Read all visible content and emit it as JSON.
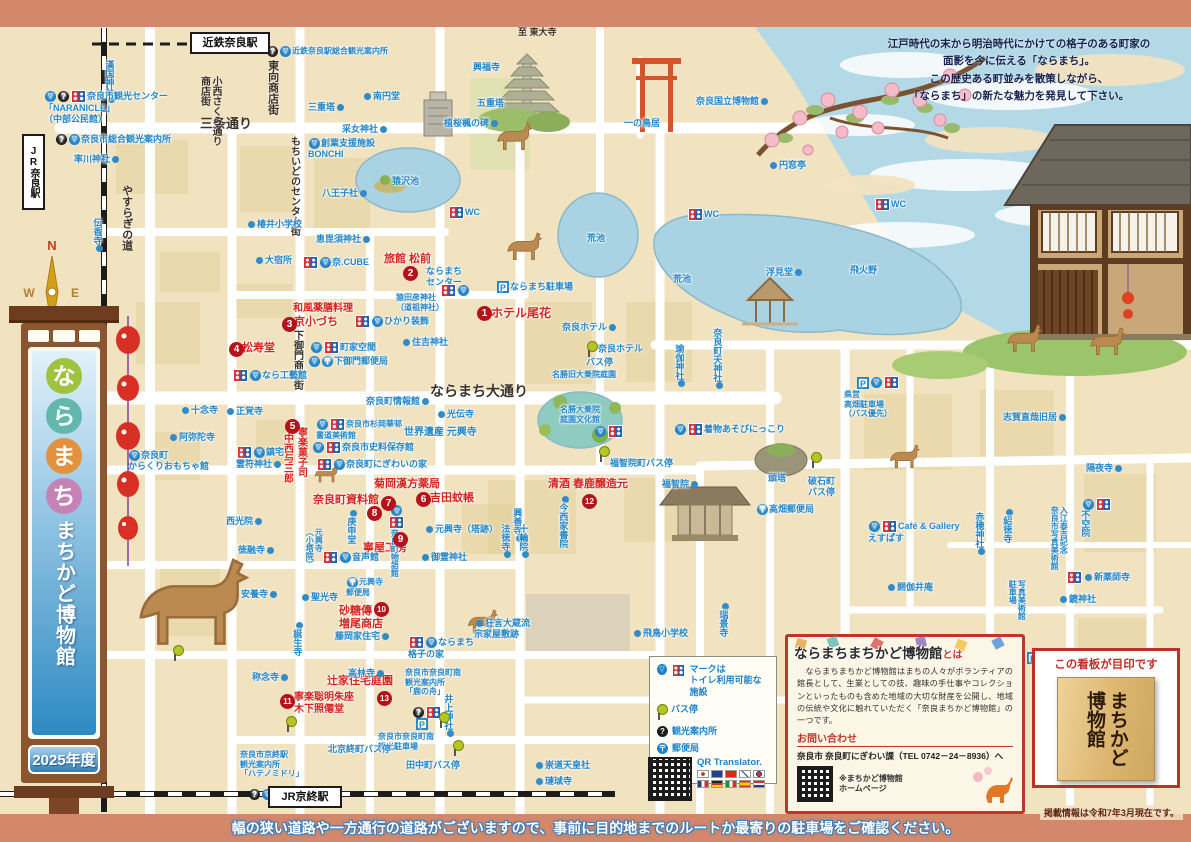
{
  "title": "ならまち まちかど博物館 マップ 2025年度",
  "header": {
    "note": "江戸時代の末から明治時代にかけての格子のある町家の\n面影を今に伝える「ならまち」。\nこの歴史ある町並みを散策しながら、\n「ならまち」の新たな魅力を発見して下さい。"
  },
  "stations": {
    "kintetsu": "近鉄奈良駅",
    "jr_nara": "JR奈良駅",
    "jr_kyobate": "JR京終駅"
  },
  "compass": {
    "n": "N",
    "e": "E",
    "w": "W",
    "s": "S"
  },
  "sidebar_sign": {
    "chars": [
      {
        "ch": "な",
        "color": "#9fc23f"
      },
      {
        "ch": "ら",
        "color": "#62b8ad"
      },
      {
        "ch": "ま",
        "color": "#e2923f"
      },
      {
        "ch": "ち",
        "color": "#c583b5"
      }
    ],
    "subtitle": "まちかど博物館",
    "year": "2025年度"
  },
  "legend": {
    "row1": "マークは\nトイレ利用可能な施設",
    "row2": "バス停",
    "row3": "観光案内所",
    "row4": "郵便局"
  },
  "qr_translator": {
    "label": "QR Translator."
  },
  "info_box": {
    "title": "ならまちまちかど博物館",
    "title_suffix": "とは",
    "body": "　ならまちまちかど博物館はまちの人々がボランティアの館長として、生業としての技、趣味の手仕事やコレクションといったものも含めた地域の大切な財産を公開し、地域の伝統や文化に触れていただく「奈良まちかど博物館」の一つです。",
    "contact_heading": "お問い合わせ",
    "contact": "奈良市 奈良町にぎわい課（TEL 0742－24－8936）へ",
    "qr_caption": "※まちかど博物館\nホームページ"
  },
  "signboard_box": {
    "caption": "この看板が目印です",
    "board_text": "まちかど\n博物館"
  },
  "footer": {
    "warning": "幅の狭い道路や一方通行の道路がございますので、事前に目的地までのルートか最寄りの駐車場をご確認ください。",
    "note": "掲載情報は令和7年3月現在です。"
  },
  "museums": [
    {
      "no": 1,
      "name": "ホテル尾花"
    },
    {
      "no": 2,
      "name": "旅館 松前"
    },
    {
      "no": 3,
      "name": "和風薬膳料理 京小づち"
    },
    {
      "no": 4,
      "name": "松寿堂"
    },
    {
      "no": 5,
      "name": "寧楽菓子司 中西与三郎"
    },
    {
      "no": 6,
      "name": "吉田蚊帳"
    },
    {
      "no": 7,
      "name": "菊岡漢方薬局"
    },
    {
      "no": 8,
      "name": "奈良町資料館"
    },
    {
      "no": 9,
      "name": "寧屋工房"
    },
    {
      "no": 10,
      "name": "砂糖傳 増尾商店"
    },
    {
      "no": 11,
      "name": "寧楽聡明朱座 木下照僊堂"
    },
    {
      "no": 12,
      "name": "清酒 春鹿醸造元"
    },
    {
      "no": 13,
      "name": "辻家住宅庭園"
    }
  ],
  "badges": [
    {
      "n": "1",
      "x": 477,
      "y": 306
    },
    {
      "n": "2",
      "x": 403,
      "y": 266
    },
    {
      "n": "3",
      "x": 282,
      "y": 317
    },
    {
      "n": "4",
      "x": 229,
      "y": 342
    },
    {
      "n": "5",
      "x": 285,
      "y": 419
    },
    {
      "n": "6",
      "x": 416,
      "y": 492
    },
    {
      "n": "7",
      "x": 381,
      "y": 496
    },
    {
      "n": "8",
      "x": 367,
      "y": 506
    },
    {
      "n": "9",
      "x": 393,
      "y": 532
    },
    {
      "n": "10",
      "x": 374,
      "y": 602
    },
    {
      "n": "11",
      "x": 280,
      "y": 694
    },
    {
      "n": "12",
      "x": 582,
      "y": 494
    },
    {
      "n": "13",
      "x": 377,
      "y": 691
    }
  ],
  "map_labels": [
    {
      "t": "三条通り",
      "x": 200,
      "y": 116,
      "c": "k",
      "s": 13
    },
    {
      "t": "やすらぎの道",
      "x": 120,
      "y": 185,
      "c": "k",
      "v": 1,
      "s": 11
    },
    {
      "t": "小西さくら通り\n商店街",
      "x": 198,
      "y": 76,
      "c": "k",
      "v": 1,
      "s": 10
    },
    {
      "t": "東向商店街",
      "x": 266,
      "y": 60,
      "c": "k",
      "v": 1,
      "s": 11
    },
    {
      "t": "もちいどのセンター街",
      "x": 288,
      "y": 136,
      "c": "k",
      "v": 1,
      "s": 10
    },
    {
      "t": "下御門商店街",
      "x": 291,
      "y": 330,
      "c": "k",
      "v": 1,
      "s": 10
    },
    {
      "t": "ならまち大通り",
      "x": 430,
      "y": 383,
      "c": "k",
      "s": 14
    },
    {
      "t": "至 東大寺",
      "x": 518,
      "y": 27,
      "c": "k",
      "s": 9
    },
    {
      "t": "ホテル尾花",
      "x": 491,
      "y": 306,
      "c": "r",
      "s": 12
    },
    {
      "t": "旅館 松前",
      "x": 384,
      "y": 253,
      "c": "r",
      "s": 11
    },
    {
      "t": "和風薬膳料理",
      "x": 293,
      "y": 303,
      "c": "r",
      "s": 10
    },
    {
      "t": "京小づち",
      "x": 294,
      "y": 316,
      "c": "r",
      "s": 11
    },
    {
      "t": "松寿堂",
      "x": 242,
      "y": 342,
      "c": "r",
      "s": 11
    },
    {
      "t": "寧楽菓子司",
      "x": 295,
      "y": 427,
      "c": "r",
      "v": 1,
      "s": 10
    },
    {
      "t": "中西与三郎",
      "x": 281,
      "y": 433,
      "c": "r",
      "v": 1,
      "s": 10
    },
    {
      "t": "吉田蚊帳",
      "x": 430,
      "y": 492,
      "c": "r",
      "s": 11
    },
    {
      "t": "菊岡漢方薬局",
      "x": 374,
      "y": 478,
      "c": "r",
      "s": 11
    },
    {
      "t": "奈良町資料館",
      "x": 313,
      "y": 494,
      "c": "r",
      "s": 11
    },
    {
      "t": "寧屋工房",
      "x": 363,
      "y": 542,
      "c": "r",
      "s": 11
    },
    {
      "t": "砂糖傳\n増尾商店",
      "x": 339,
      "y": 605,
      "c": "r",
      "s": 11
    },
    {
      "t": "寧楽聡明朱座\n木下照僊堂",
      "x": 294,
      "y": 692,
      "c": "r",
      "s": 10
    },
    {
      "t": "清酒 春鹿醸造元",
      "x": 548,
      "y": 478,
      "c": "r",
      "s": 11
    },
    {
      "t": "辻家住宅庭園",
      "x": 327,
      "y": 675,
      "c": "r",
      "s": 11
    },
    {
      "t": "漢国神社",
      "x": 104,
      "y": 60,
      "v": 1,
      "d": "b"
    },
    {
      "t": "奈良市観光センター\n「NARANICLE」\n（中部公民館）",
      "x": 44,
      "y": 90,
      "i": [
        "tri",
        "info",
        "wc"
      ]
    },
    {
      "t": "奈良市総合観光案内所",
      "x": 55,
      "y": 134,
      "i": [
        "info",
        "tri"
      ]
    },
    {
      "t": "率川神社",
      "x": 74,
      "y": 154,
      "d": "r"
    },
    {
      "t": "伝香寺",
      "x": 92,
      "y": 218,
      "v": 1,
      "d": "r"
    },
    {
      "t": "近鉄奈良駅総合観光案内所",
      "x": 266,
      "y": 46,
      "s": 8,
      "i": [
        "info",
        "tri"
      ]
    },
    {
      "t": "南円堂",
      "x": 362,
      "y": 91,
      "d": "l"
    },
    {
      "t": "三重塔",
      "x": 308,
      "y": 102,
      "d": "r"
    },
    {
      "t": "采女神社",
      "x": 342,
      "y": 124,
      "d": "r"
    },
    {
      "t": "創業支援施設\nBONCHI",
      "x": 308,
      "y": 138,
      "i": [
        "tri"
      ]
    },
    {
      "t": "八王子社",
      "x": 322,
      "y": 188,
      "d": "r"
    },
    {
      "t": "椿井小学校",
      "x": 246,
      "y": 219,
      "d": "l"
    },
    {
      "t": "恵毘須神社",
      "x": 316,
      "y": 234,
      "d": "r"
    },
    {
      "t": "大宿所",
      "x": 254,
      "y": 255,
      "d": "l"
    },
    {
      "t": "奈.CUBE",
      "x": 302,
      "y": 256,
      "i": [
        "wc",
        "tri"
      ]
    },
    {
      "t": "ならまち\nセンター",
      "x": 426,
      "y": 266
    },
    {
      "i": [
        "wc",
        "tri"
      ],
      "x": 440,
      "y": 284
    },
    {
      "t": "猿田彦神社\n（道祖神社）",
      "x": 396,
      "y": 293,
      "s": 8
    },
    {
      "t": "ならまち駐車場",
      "x": 496,
      "y": 281,
      "i": [
        "p"
      ]
    },
    {
      "t": "住吉神社",
      "x": 401,
      "y": 337,
      "d": "l"
    },
    {
      "t": "ひかり装飾",
      "x": 354,
      "y": 315,
      "i": [
        "wc",
        "tri"
      ]
    },
    {
      "t": "町家空間",
      "x": 310,
      "y": 341,
      "i": [
        "tri",
        "wc"
      ]
    },
    {
      "t": "下御門郵便局",
      "x": 308,
      "y": 356,
      "i": [
        "tri",
        "post"
      ]
    },
    {
      "t": "なら工藝館",
      "x": 232,
      "y": 369,
      "i": [
        "wc",
        "tri"
      ]
    },
    {
      "t": "興福寺",
      "x": 473,
      "y": 62
    },
    {
      "t": "五重塔",
      "x": 477,
      "y": 98
    },
    {
      "t": "植桜楓の碑",
      "x": 444,
      "y": 118,
      "d": "r"
    },
    {
      "t": "猿沢池",
      "x": 392,
      "y": 176
    },
    {
      "t": "WC",
      "x": 448,
      "y": 206,
      "i": [
        "wc"
      ]
    },
    {
      "t": "WC",
      "x": 687,
      "y": 208,
      "i": [
        "wc"
      ]
    },
    {
      "t": "WC",
      "x": 874,
      "y": 198,
      "i": [
        "wc"
      ]
    },
    {
      "t": "一の鳥居",
      "x": 624,
      "y": 118
    },
    {
      "t": "奈良国立博物館",
      "x": 696,
      "y": 96,
      "d": "b"
    },
    {
      "t": "円窓亭",
      "x": 768,
      "y": 160,
      "d": "a"
    },
    {
      "t": "浮見堂",
      "x": 766,
      "y": 267,
      "d": "b"
    },
    {
      "t": "飛火野",
      "x": 850,
      "y": 265
    },
    {
      "t": "荒池",
      "x": 587,
      "y": 233
    },
    {
      "t": "荒池",
      "x": 673,
      "y": 274
    },
    {
      "t": "奈良ホテル",
      "x": 562,
      "y": 322,
      "d": "b"
    },
    {
      "t": "奈良ホテル\nバス停",
      "x": 586,
      "y": 341,
      "i": [
        "pin"
      ]
    },
    {
      "t": "瑜伽神社",
      "x": 674,
      "y": 344,
      "v": 1,
      "d": "b"
    },
    {
      "t": "奈良町天神社",
      "x": 712,
      "y": 328,
      "v": 1,
      "d": "b"
    },
    {
      "t": "名勝旧大乗院庭園",
      "x": 552,
      "y": 370,
      "s": 8
    },
    {
      "t": "名勝大乗院\n庭園文化館",
      "x": 560,
      "y": 405,
      "s": 8
    },
    {
      "i": [
        "tri",
        "wc"
      ],
      "x": 594,
      "y": 425
    },
    {
      "t": "県営\n高畑駐車場\n（バス優先）",
      "x": 844,
      "y": 390,
      "s": 8
    },
    {
      "i": [
        "p",
        "tri",
        "wc"
      ],
      "x": 856,
      "y": 376
    },
    {
      "t": "着物あそびにっこり",
      "x": 674,
      "y": 423,
      "i": [
        "tri",
        "wc"
      ]
    },
    {
      "t": "福智院町バス停",
      "x": 610,
      "y": 458
    },
    {
      "i": [
        "pin"
      ],
      "x": 598,
      "y": 446
    },
    {
      "t": "福智院",
      "x": 662,
      "y": 479,
      "d": "b"
    },
    {
      "t": "頭塔",
      "x": 768,
      "y": 473
    },
    {
      "t": "破石町\nバス停",
      "x": 808,
      "y": 476
    },
    {
      "i": [
        "pin"
      ],
      "x": 810,
      "y": 452
    },
    {
      "t": "高畑郵便局",
      "x": 756,
      "y": 504,
      "i": [
        "post"
      ]
    },
    {
      "t": "閼伽井庵",
      "x": 886,
      "y": 582,
      "d": "l"
    },
    {
      "t": "Café & Gallery\nえすぱす",
      "x": 868,
      "y": 520,
      "i": [
        "tri",
        "wc"
      ]
    },
    {
      "t": "赤穂神社",
      "x": 974,
      "y": 512,
      "v": 1,
      "d": "b"
    },
    {
      "t": "紹徳寺",
      "x": 1002,
      "y": 509,
      "v": 1,
      "d": "a"
    },
    {
      "t": "志賀直哉旧居",
      "x": 1003,
      "y": 412,
      "d": "b"
    },
    {
      "t": "隔夜寺",
      "x": 1086,
      "y": 463,
      "d": "r"
    },
    {
      "t": "不空院",
      "x": 1080,
      "y": 510,
      "v": 1
    },
    {
      "i": [
        "tri",
        "wc"
      ],
      "x": 1082,
      "y": 498
    },
    {
      "t": "入江泰吉記念\n奈良市写真美術館",
      "x": 1050,
      "y": 506,
      "v": 1,
      "s": 8
    },
    {
      "t": "新薬師寺",
      "x": 1066,
      "y": 571,
      "d": "l",
      "i": [
        "wc"
      ]
    },
    {
      "t": "鏡神社",
      "x": 1058,
      "y": 594,
      "d": "l"
    },
    {
      "t": "写真美術館\n駐車場",
      "x": 1008,
      "y": 580,
      "v": 1,
      "s": 8
    },
    {
      "i": [
        "p"
      ],
      "x": 1026,
      "y": 652
    },
    {
      "t": "奈良町情報館",
      "x": 366,
      "y": 396,
      "d": "b"
    },
    {
      "t": "光伝寺",
      "x": 436,
      "y": 409,
      "d": "l"
    },
    {
      "t": "世界遺産 元興寺",
      "x": 404,
      "y": 427,
      "s": 10
    },
    {
      "t": "十念寺",
      "x": 180,
      "y": 405,
      "d": "l"
    },
    {
      "t": "正覚寺",
      "x": 225,
      "y": 406,
      "d": "l"
    },
    {
      "t": "阿弥陀寺",
      "x": 168,
      "y": 432,
      "d": "l"
    },
    {
      "t": "奈良町\nからくりおもちゃ館",
      "x": 128,
      "y": 450,
      "i": [
        "tri"
      ]
    },
    {
      "t": "鎮宅\n霊符神社",
      "x": 236,
      "y": 446,
      "i": [
        "wc",
        "tri"
      ],
      "d": "r"
    },
    {
      "t": "奈良市杉岡華邨\n書道美術館",
      "x": 316,
      "y": 418,
      "s": 8,
      "i": [
        "tri",
        "wc"
      ]
    },
    {
      "t": "奈良市史料保存館",
      "x": 312,
      "y": 441,
      "i": [
        "tri",
        "wc"
      ]
    },
    {
      "t": "奈良町にぎわいの家",
      "x": 316,
      "y": 458,
      "i": [
        "wc",
        "tri"
      ]
    },
    {
      "t": "奈良町物語館",
      "x": 388,
      "y": 505,
      "v": 1,
      "s": 8,
      "i": [
        "tri",
        "wc"
      ]
    },
    {
      "t": "元興寺（塔跡）",
      "x": 424,
      "y": 524,
      "d": "a"
    },
    {
      "t": "御霊神社",
      "x": 420,
      "y": 552,
      "d": "l"
    },
    {
      "t": "興善寺",
      "x": 512,
      "y": 508,
      "v": 1,
      "d": "b"
    },
    {
      "t": "法徳寺",
      "x": 500,
      "y": 524,
      "v": 1,
      "d": "b"
    },
    {
      "t": "十輪院",
      "x": 518,
      "y": 524,
      "v": 1,
      "d": "b"
    },
    {
      "t": "今西家書院",
      "x": 558,
      "y": 496,
      "v": 1,
      "d": "a"
    },
    {
      "t": "庚申堂",
      "x": 346,
      "y": 510,
      "v": 1,
      "d": "a"
    },
    {
      "t": "元興寺\n（小塔院）",
      "x": 305,
      "y": 528,
      "v": 1,
      "s": 8
    },
    {
      "t": "音声館",
      "x": 322,
      "y": 551,
      "i": [
        "wc",
        "tri"
      ]
    },
    {
      "t": "元興寺\n郵便局",
      "x": 346,
      "y": 577,
      "s": 8,
      "i": [
        "post"
      ]
    },
    {
      "t": "聖光寺",
      "x": 300,
      "y": 592,
      "d": "l"
    },
    {
      "t": "誕生寺",
      "x": 292,
      "y": 622,
      "v": 1,
      "d": "a"
    },
    {
      "t": "藤岡家住宅",
      "x": 335,
      "y": 631,
      "d": "r"
    },
    {
      "t": "ならまち\n格子の家",
      "x": 408,
      "y": 636,
      "i": [
        "wc",
        "tri"
      ]
    },
    {
      "t": "狂言大蔵流\n宗家屋敷跡",
      "x": 474,
      "y": 618,
      "d": "a"
    },
    {
      "t": "飛鳥小学校",
      "x": 632,
      "y": 628,
      "d": "l"
    },
    {
      "t": "瑞景寺",
      "x": 718,
      "y": 603,
      "v": 1,
      "d": "a"
    },
    {
      "t": "高林寺",
      "x": 348,
      "y": 668,
      "d": "r"
    },
    {
      "t": "称念寺",
      "x": 252,
      "y": 672,
      "d": "r"
    },
    {
      "t": "西光院",
      "x": 226,
      "y": 516,
      "d": "r"
    },
    {
      "t": "徳融寺",
      "x": 238,
      "y": 545,
      "d": "r"
    },
    {
      "t": "安養寺",
      "x": 241,
      "y": 589,
      "d": "r"
    },
    {
      "t": "井上神社",
      "x": 443,
      "y": 694,
      "v": 1,
      "d": "b"
    },
    {
      "t": "奈良市奈良町南\n観光案内所\n「鹿の舟」",
      "x": 405,
      "y": 668,
      "s": 8
    },
    {
      "i": [
        "info",
        "wc"
      ],
      "x": 412,
      "y": 706
    },
    {
      "t": "奈良市奈良町南\n観光駐車場",
      "x": 378,
      "y": 732,
      "s": 8
    },
    {
      "i": [
        "p"
      ],
      "x": 415,
      "y": 718
    },
    {
      "t": "北京終町バス停",
      "x": 328,
      "y": 744
    },
    {
      "i": [
        "pin"
      ],
      "x": 285,
      "y": 716
    },
    {
      "t": "田中町バス停",
      "x": 406,
      "y": 760
    },
    {
      "i": [
        "pin"
      ],
      "x": 438,
      "y": 712
    },
    {
      "i": [
        "pin"
      ],
      "x": 452,
      "y": 740
    },
    {
      "i": [
        "pin"
      ],
      "x": 172,
      "y": 645
    },
    {
      "t": "奈良市京終駅\n観光案内所\n「ハテノミドリ」",
      "x": 240,
      "y": 750,
      "s": 8
    },
    {
      "i": [
        "info",
        "tri",
        "wc"
      ],
      "x": 248,
      "y": 788
    },
    {
      "t": "崇道天皇社",
      "x": 534,
      "y": 760,
      "d": "l"
    },
    {
      "t": "璉珹寺",
      "x": 534,
      "y": 776,
      "d": "l"
    }
  ]
}
